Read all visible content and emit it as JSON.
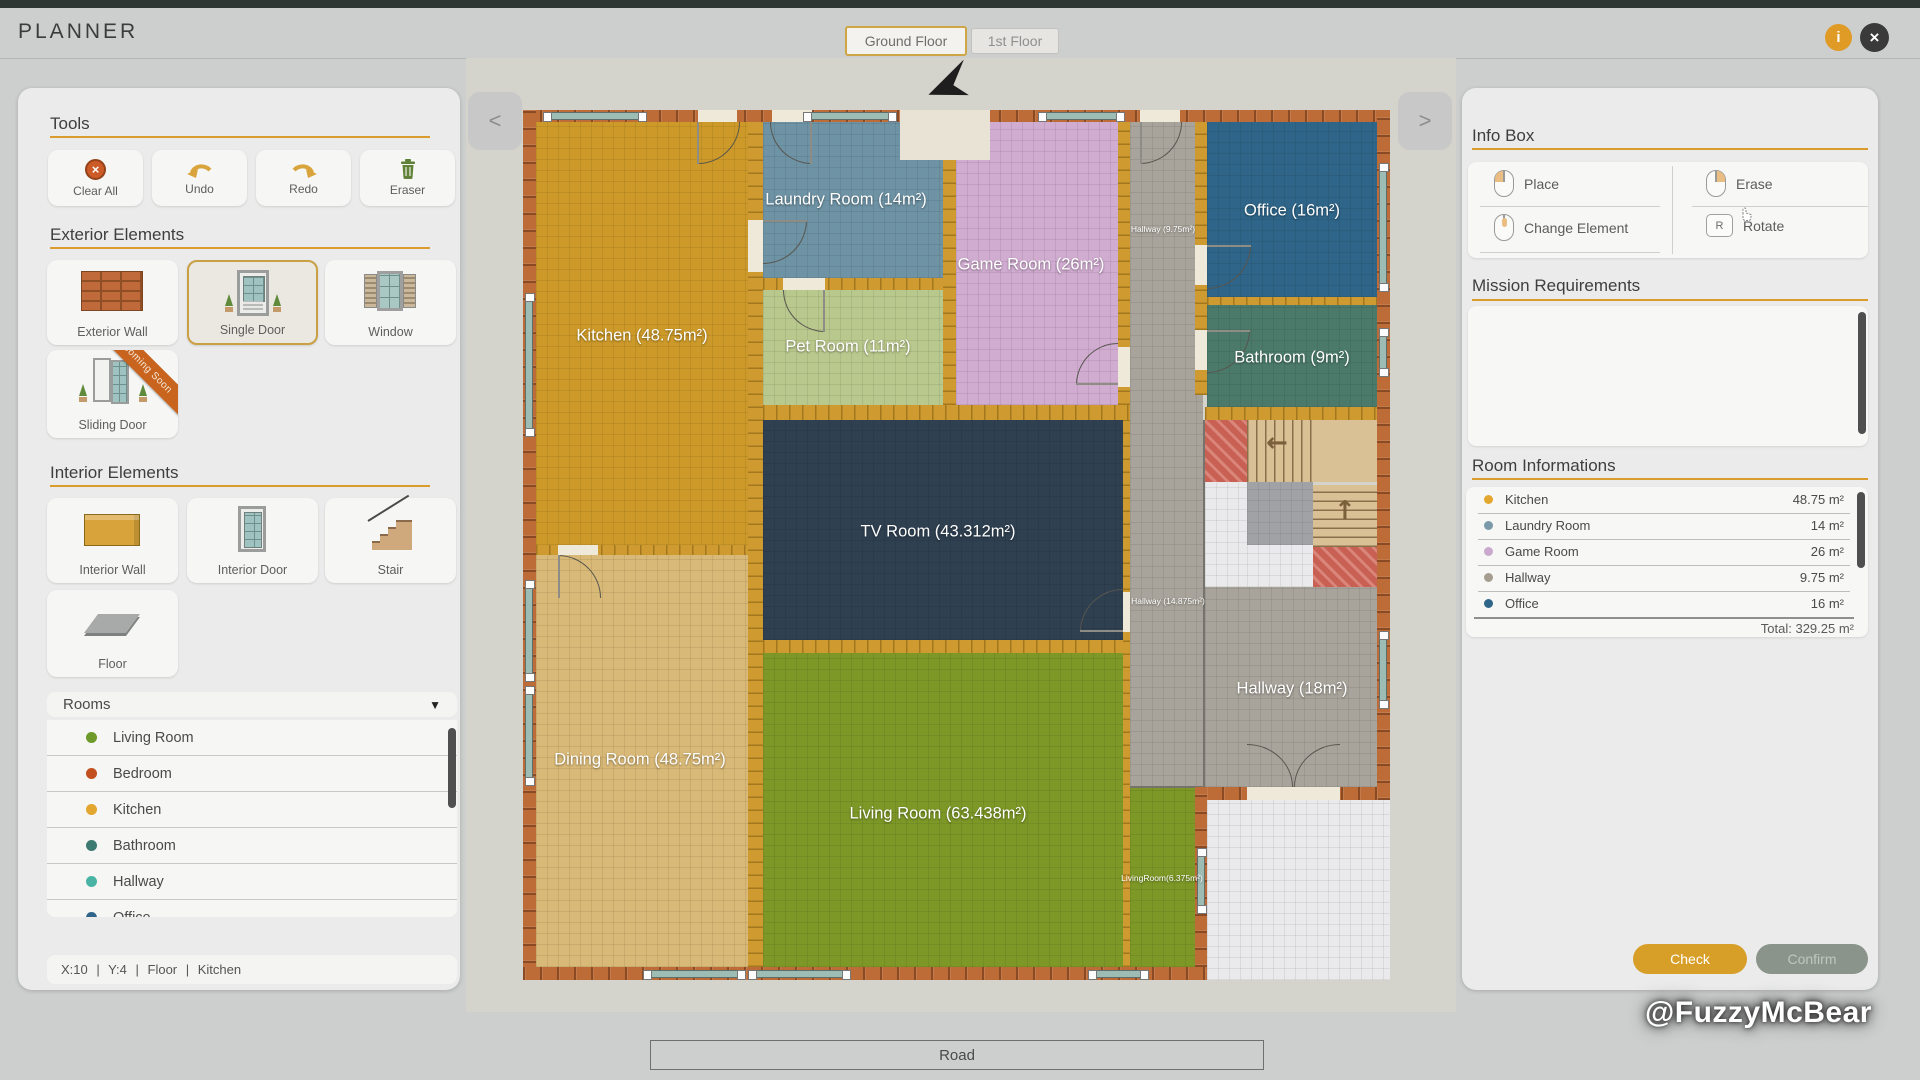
{
  "topbar": {
    "title": "PLANNER",
    "tab_ground": "Ground Floor",
    "tab_first": "1st Floor"
  },
  "sidebar": {
    "tools": {
      "heading": "Tools",
      "clear_all": "Clear All",
      "undo": "Undo",
      "redo": "Redo",
      "eraser": "Eraser"
    },
    "exterior": {
      "heading": "Exterior Elements",
      "wall": "Exterior Wall",
      "single_door": "Single Door",
      "window": "Window",
      "sliding_door": "Sliding Door",
      "coming_soon": "Coming Soon"
    },
    "interior": {
      "heading": "Interior Elements",
      "wall": "Interior Wall",
      "door": "Interior Door",
      "stair": "Stair",
      "floor": "Floor"
    },
    "rooms": {
      "heading": "Rooms",
      "items": [
        {
          "label": "Living Room",
          "color": "#6d9a2b"
        },
        {
          "label": "Bedroom",
          "color": "#c2511f"
        },
        {
          "label": "Kitchen",
          "color": "#e3a72f"
        },
        {
          "label": "Bathroom",
          "color": "#3d7a71"
        },
        {
          "label": "Hallway",
          "color": "#4ab4a4"
        },
        {
          "label": "Office",
          "color": "#2e6588"
        }
      ]
    },
    "status": "X:10 | Y:4 | Floor | Kitchen"
  },
  "plan": {
    "rooms": {
      "kitchen": {
        "label": "Kitchen (48.75m²)",
        "color": "#cd9a29"
      },
      "dining": {
        "label": "Dining Room (48.75m²)",
        "color": "#d9b977"
      },
      "laundry": {
        "label": "Laundry Room (14m²)",
        "color": "#6e93a5"
      },
      "pet": {
        "label": "Pet Room (11m²)",
        "color": "#b9c88d"
      },
      "game": {
        "label": "Game Room (26m²)",
        "color": "#d1acd1"
      },
      "office": {
        "label": "Office (16m²)",
        "color": "#2f6588"
      },
      "bathroom": {
        "label": "Bathroom (9m²)",
        "color": "#4b7a6b"
      },
      "tv": {
        "label": "TV Room (43.312m²)",
        "color": "#2f4051"
      },
      "living": {
        "label": "Living Room (63.438m²)",
        "color": "#7d9827"
      },
      "hallway": {
        "label": "Hallway (18m²)",
        "color": "#a9a49b"
      },
      "hallway_small": {
        "label": "Hallway (9.75m²)",
        "color": "#a9a49b"
      },
      "hallway_mid": {
        "label": "Hallway (14.875m²)",
        "color": "#a9a49b"
      },
      "living_strip": {
        "label": "LivingRoom(6.375m²)",
        "color": "#7d9827"
      }
    },
    "road": "Road"
  },
  "infobox": {
    "heading": "Info Box",
    "place": "Place",
    "erase": "Erase",
    "change": "Change Element",
    "rotate": "Rotate",
    "rotate_key": "R"
  },
  "mission": {
    "heading": "Mission Requirements"
  },
  "room_info": {
    "heading": "Room Informations",
    "rows": [
      {
        "name": "Kitchen",
        "area": "48.75 m²",
        "color": "#e3a72f"
      },
      {
        "name": "Laundry Room",
        "area": "14 m²",
        "color": "#7b99a9"
      },
      {
        "name": "Game Room",
        "area": "26 m²",
        "color": "#cba9ce"
      },
      {
        "name": "Hallway",
        "area": "9.75 m²",
        "color": "#a59d90"
      },
      {
        "name": "Office",
        "area": "16 m²",
        "color": "#2e6588"
      }
    ],
    "total": "Total: 329.25 m²"
  },
  "actions": {
    "check": "Check",
    "confirm": "Confirm"
  },
  "watermark": "@FuzzyMcBear"
}
